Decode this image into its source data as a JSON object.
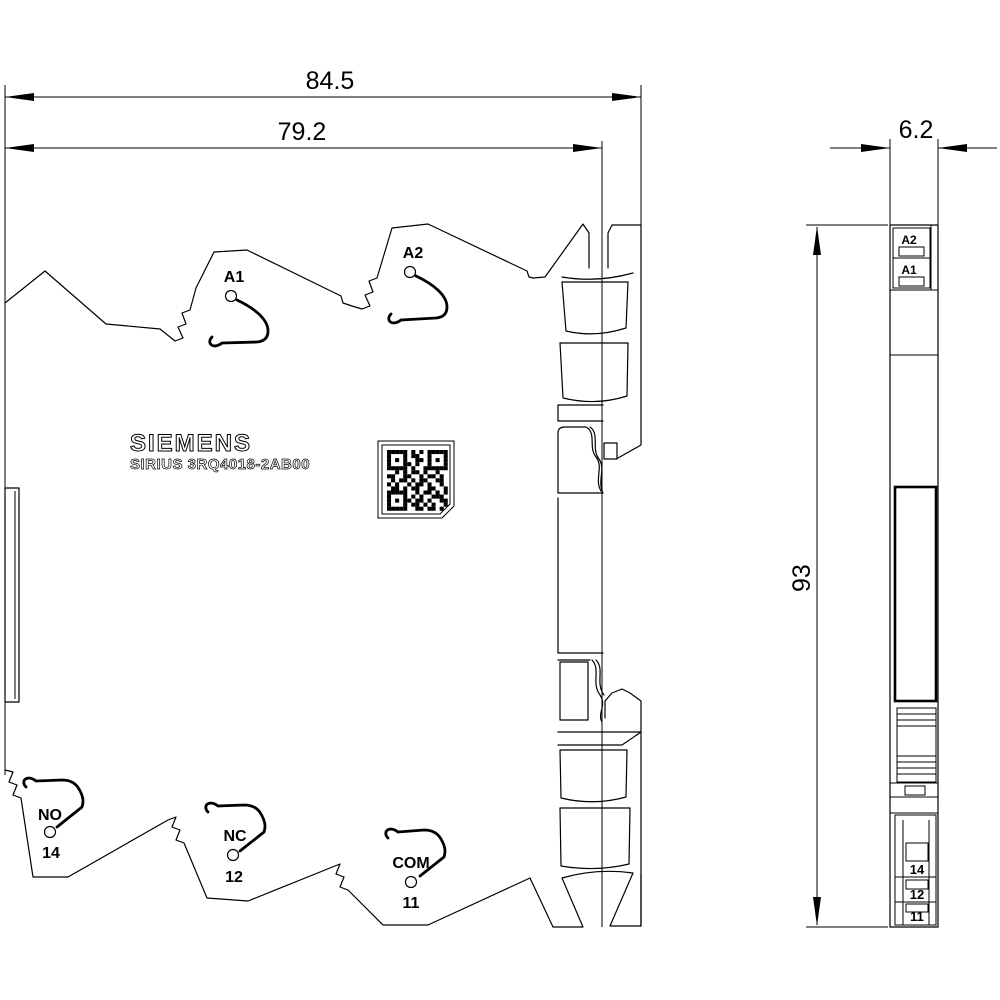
{
  "title": "Siemens SIRIUS 3RQ4018-2AB00 dimension drawing",
  "brand": "SIEMENS",
  "product": "SIRIUS 3RQ4018-2AB00",
  "dims": {
    "overall_width": "84.5",
    "body_width": "79.2",
    "depth": "6.2",
    "height": "93"
  },
  "front": {
    "a1": "A1",
    "a2": "A2",
    "no": "NO",
    "no_num": "14",
    "nc": "NC",
    "nc_num": "12",
    "com": "COM",
    "com_num": "11"
  },
  "side": {
    "a2": "A2",
    "a1": "A1",
    "n14": "14",
    "n12": "12",
    "n11": "11"
  },
  "colors": {
    "line": "#000000",
    "background": "#ffffff"
  },
  "qr_rows": [
    "111110101011111",
    "100010110010001",
    "101010011010101",
    "100011010010001",
    "111110100111111",
    "001010110100100",
    "110011001011010",
    "010110101100110",
    "101001011010010",
    "011010110011001",
    "111110010110101",
    "100010101001110",
    "101011011010011",
    "100010110101001",
    "111110011011010"
  ]
}
